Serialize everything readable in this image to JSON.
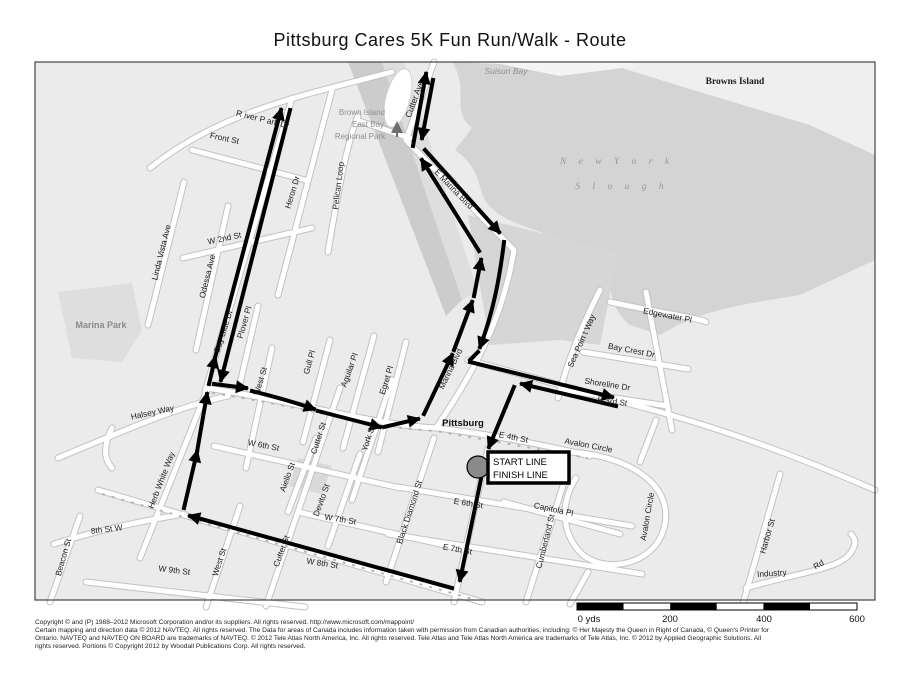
{
  "title": "Pittsburg Cares 5K Fun Run/Walk -  Route",
  "colors": {
    "water": "#d4d4d4",
    "land": "#ebebeb",
    "route": "#000000",
    "start_circle": "#8a8a8a"
  },
  "map": {
    "areas": {
      "suisun_bay": "Suisun Bay",
      "browns_island": "Browns Island",
      "new_york_1": "N e w     Y o r k",
      "new_york_2": "S l o u g h",
      "marina_park": "Marina Park",
      "brown_park_1": "Brown Island",
      "brown_park_2": "East Bay",
      "brown_park_3": "Regional Park",
      "city": "Pittsburg"
    },
    "streets": {
      "river_park_dr": "R iver P ark Dr",
      "front_st": "Front St",
      "heron_dr": "Heron Dr",
      "bay_side_dr": "Bay Side Dr",
      "linda_vista_ave": "Linda Vista Ave",
      "odessa_ave": "Odessa Ave",
      "w_2nd_st": "W 2nd St",
      "plover_pl": "Plover Pl",
      "pelican_loop": "Pelican Loop",
      "cutter_ave": "Cutter Ave",
      "e_marina_blvd": "E Marina Blvd",
      "marina_blvd": "Marina Blvd",
      "halsey_way": "Halsey Way",
      "herb_white_way": "Herb White Way",
      "west_st_u": "West St",
      "gull_pl": "Gull Pl",
      "aguilar_pl": "Aguilar Pl",
      "egret_pl": "Egret Pl",
      "cutter_st_u": "Cutter St",
      "york_st": "York St",
      "w_6th_st": "W 6th St",
      "e_6th_st": "E 6th St",
      "w_7th_st": "W 7th St",
      "e_7th_st": "E 7th St",
      "w_8th_st": "W 8th St",
      "st_8th_w": "8th St W",
      "beacon_st": "Beacon St",
      "w_9th_st": "W 9th St",
      "west_st_l": "West St",
      "cutter_st_l": "Cutter St",
      "aiello_st": "Aiello St",
      "devito_st": "Devito St",
      "black_diamond_st": "Black Diamond St",
      "cumberland_st": "Cumberland St",
      "capitola_pl": "Capitola Pl",
      "e_4th_st": "E 4th St",
      "avalon_circle_1": "Avalon Circle",
      "avalon_circle_2": "Avalon Circle",
      "harbor_st": "Harbor St",
      "industry": "Industry",
      "industry_rd": "Rd",
      "e_3rd_st": "E 3rd St",
      "shoreline_dr": "Shoreline Dr",
      "bay_crest_dr": "Bay Crest Dr",
      "edgewater_pl": "Edgewater Pl",
      "sea_point_way": "Sea Poin t Way"
    },
    "markers": {
      "start_line": "START LINE",
      "finish_line": "FINISH LINE"
    },
    "scale": {
      "t0": "0 yds",
      "t200": "200",
      "t400": "400",
      "t600": "600"
    }
  },
  "footer": {
    "lines": [
      "Copyright © and (P) 1988–2012 Microsoft Corporation and/or its suppliers. All rights reserved. http://www.microsoft.com/mappoint/",
      "Certain mapping and direction data © 2012 NAVTEQ. All rights reserved. The Data for areas of Canada includes information taken with permission from Canadian authorities, including: © Her Majesty the Queen in Right of Canada, © Queen's Printer for",
      "Ontario. NAVTEQ and NAVTEQ ON BOARD are trademarks of NAVTEQ. © 2012 Tele Atlas North America, Inc. All rights reserved. Tele Atlas and Tele Atlas North America are trademarks of Tele Atlas, Inc. © 2012 by Applied Geographic Solutions. All",
      "rights reserved. Portions © Copyright 2012 by Woodall Publications Corp. All rights reserved."
    ]
  }
}
